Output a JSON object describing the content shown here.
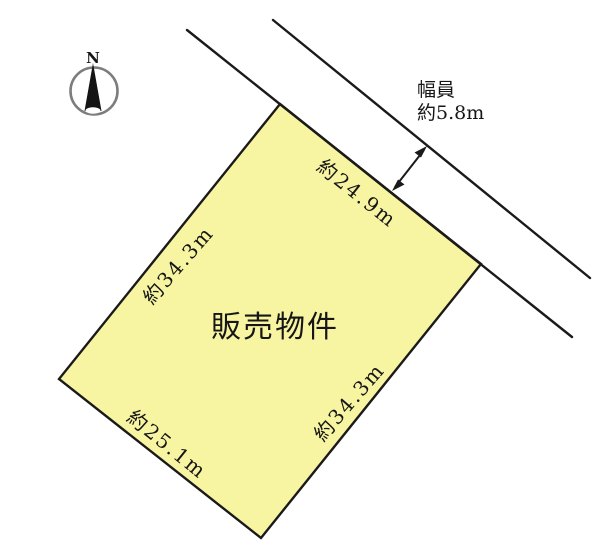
{
  "plot": {
    "label": "販売物件",
    "fill_color": "#f8f5a2"
  },
  "dimensions": {
    "north_east_side": "約24.9m",
    "north_west_side": "約34.3m",
    "south_east_side": "約34.3m",
    "south_west_side": "約25.1m"
  },
  "road": {
    "width_title": "幅員",
    "width_value": "約5.8m"
  },
  "compass": {
    "north": "N"
  },
  "colors": {
    "line": "#1a1a1a",
    "compass_ring": "#7d7d7d"
  }
}
